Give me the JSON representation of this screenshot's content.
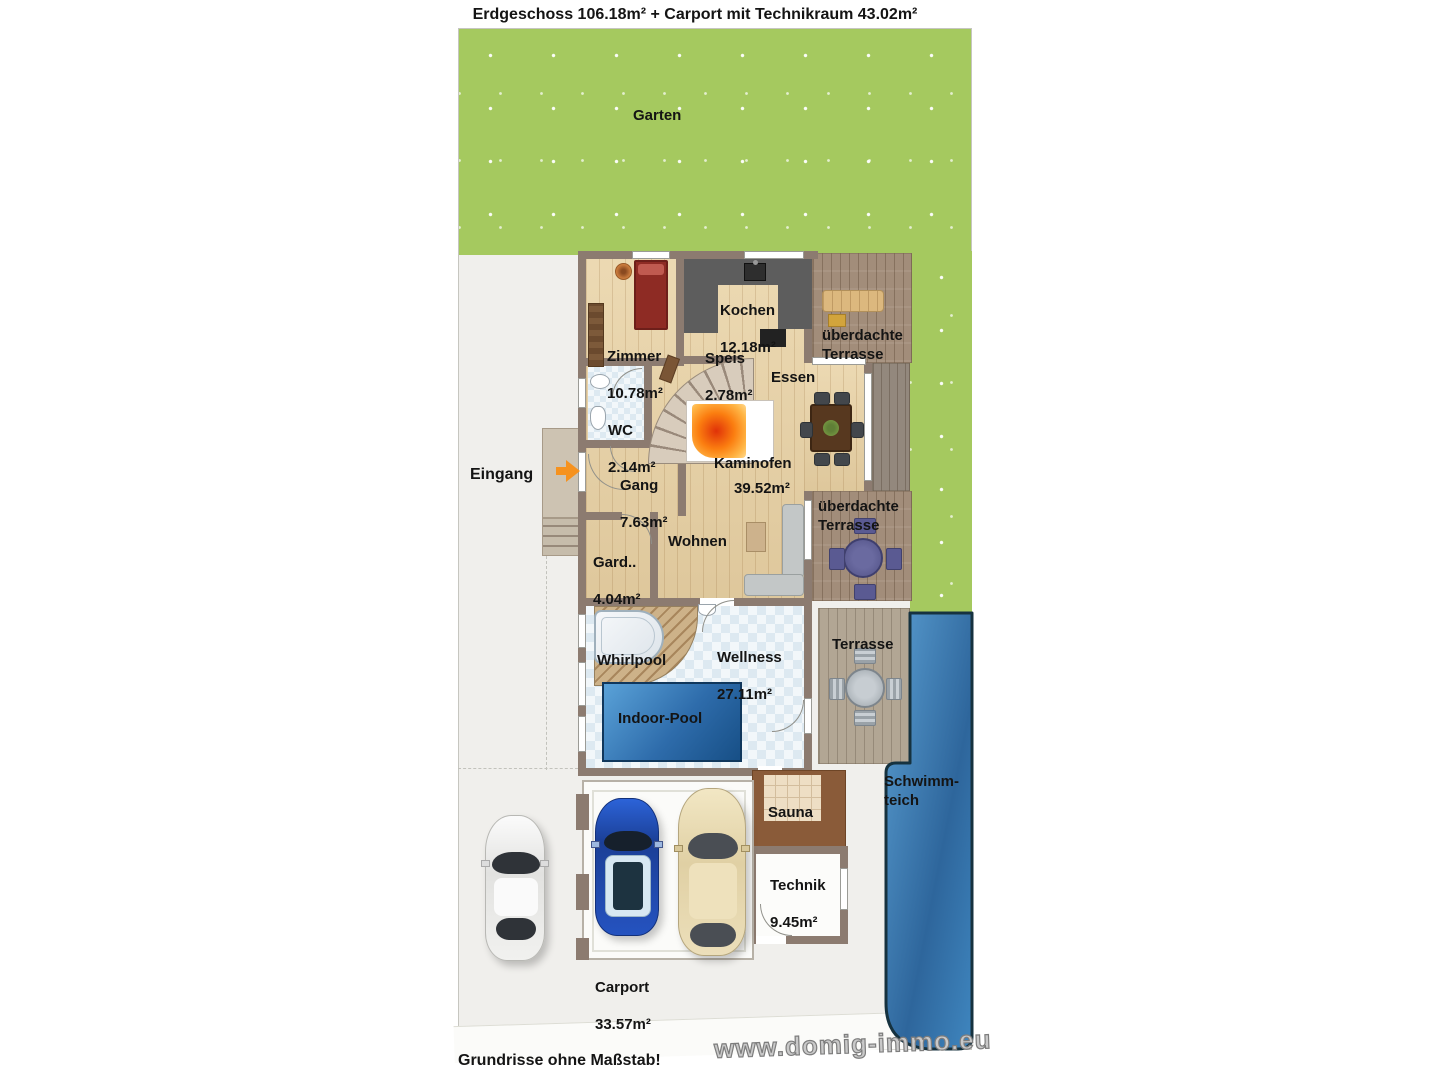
{
  "title": "Erdgeschoss 106.18m² + Carport mit Technikraum 43.02m²",
  "garden": {
    "label": "Garten"
  },
  "entrance": {
    "label": "Eingang"
  },
  "rooms": {
    "zimmer": {
      "label": "Zimmer",
      "size": "10.78m²"
    },
    "kochen": {
      "label": "Kochen",
      "size": "12.18m²"
    },
    "speis": {
      "label": "Speis",
      "size": "2.78m²"
    },
    "wc": {
      "label": "WC",
      "size": "2.14m²"
    },
    "gang": {
      "label": "Gang",
      "size": "7.63m²"
    },
    "garderobe": {
      "label": "Gard..",
      "size": "4.04m²"
    },
    "essen": {
      "label": "Essen"
    },
    "wohnen": {
      "label": "Wohnen"
    },
    "kaminofen": {
      "label": "Kaminofen",
      "size": "39.52m²"
    },
    "wellness": {
      "label": "Wellness",
      "size": "27.11m²"
    },
    "whirlpool": {
      "label": "Whirlpool"
    },
    "indoor_pool": {
      "label": "Indoor-Pool"
    },
    "sauna": {
      "label": "Sauna"
    },
    "technik": {
      "label": "Technik",
      "size": "9.45m²"
    },
    "carport": {
      "label": "Carport",
      "size": "33.57m²"
    },
    "terrasse_nord": {
      "label": "überdachte\nTerrasse"
    },
    "terrasse_mitte": {
      "label": "überdachte\nTerrasse"
    },
    "terrasse_sued": {
      "label": "Terrasse"
    },
    "schwimmteich": {
      "label": "Schwimm-\nteich"
    }
  },
  "footer": {
    "note": "Grundrisse ohne Maßstab!",
    "watermark": "www.domig-immo.eu"
  },
  "colors": {
    "grass": "#a5c95f",
    "wall": "#8c7b70",
    "wood_floor": "#ead5aa",
    "deck": "#a28d7a",
    "water": "#3f86bf",
    "arrow_accent": "#f6921e"
  }
}
